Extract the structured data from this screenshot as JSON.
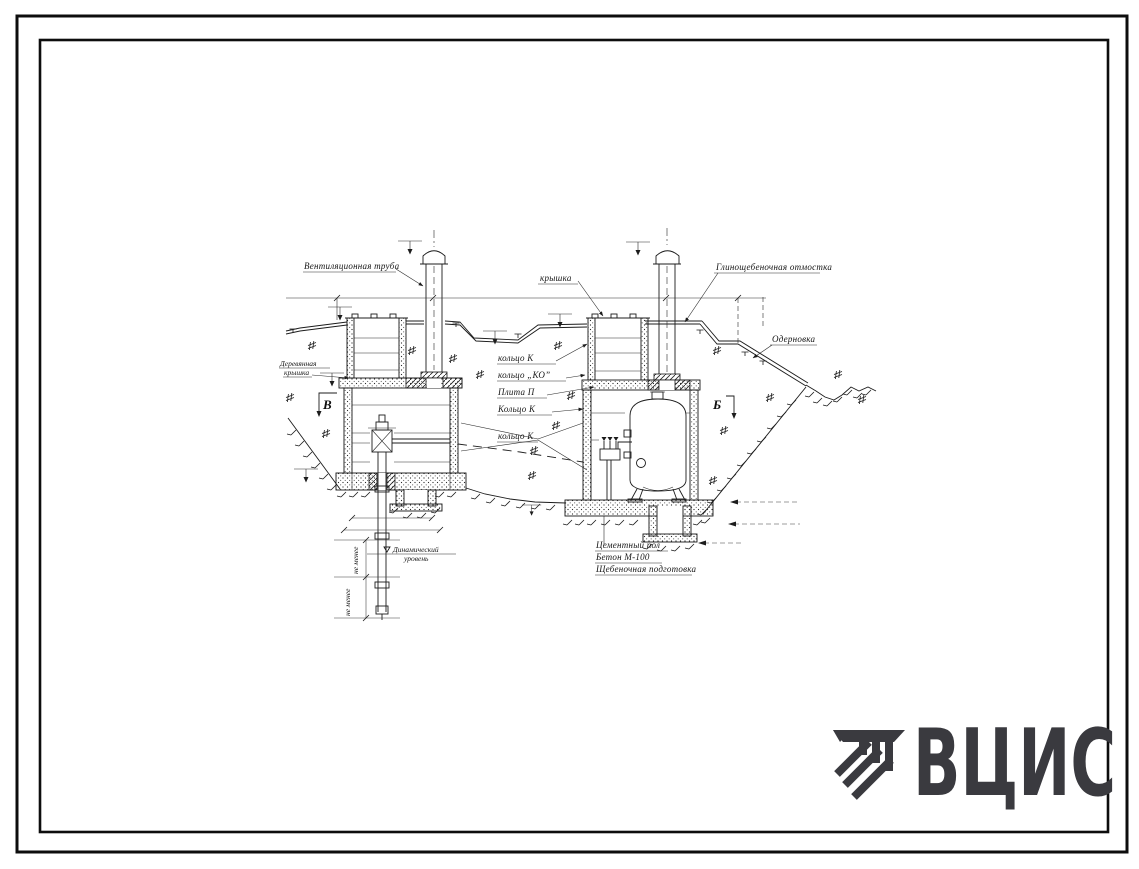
{
  "logo": {
    "text": "ВЦИС",
    "color": "#3a3a3f"
  },
  "drawing": {
    "labels": {
      "vent_pipe": "Вентиляционная труба",
      "cover": "крышка",
      "blind_area": "Глинощебеночная отмостка",
      "turfing": "Одерновка",
      "wooden_cover_1": "Деревянная",
      "wooden_cover_2": "крышка",
      "ring_k_top": "кольцо К",
      "ring_ko": "кольцо „КО”",
      "slab_p": "Плита П",
      "ring_k_mid": "Кольцо К",
      "ring_k_low": "кольцо К",
      "dynamic_level_1": "Динамический",
      "dynamic_level_2": "уровень",
      "cement_floor": "Цементный пол",
      "concrete": "Бетон М-100",
      "rubble_prep": "Щебеночная подготовка",
      "not_less_upper": "не менее",
      "not_less_lower": "не менее"
    },
    "section_marks": {
      "left": "В",
      "right": "Б"
    }
  }
}
